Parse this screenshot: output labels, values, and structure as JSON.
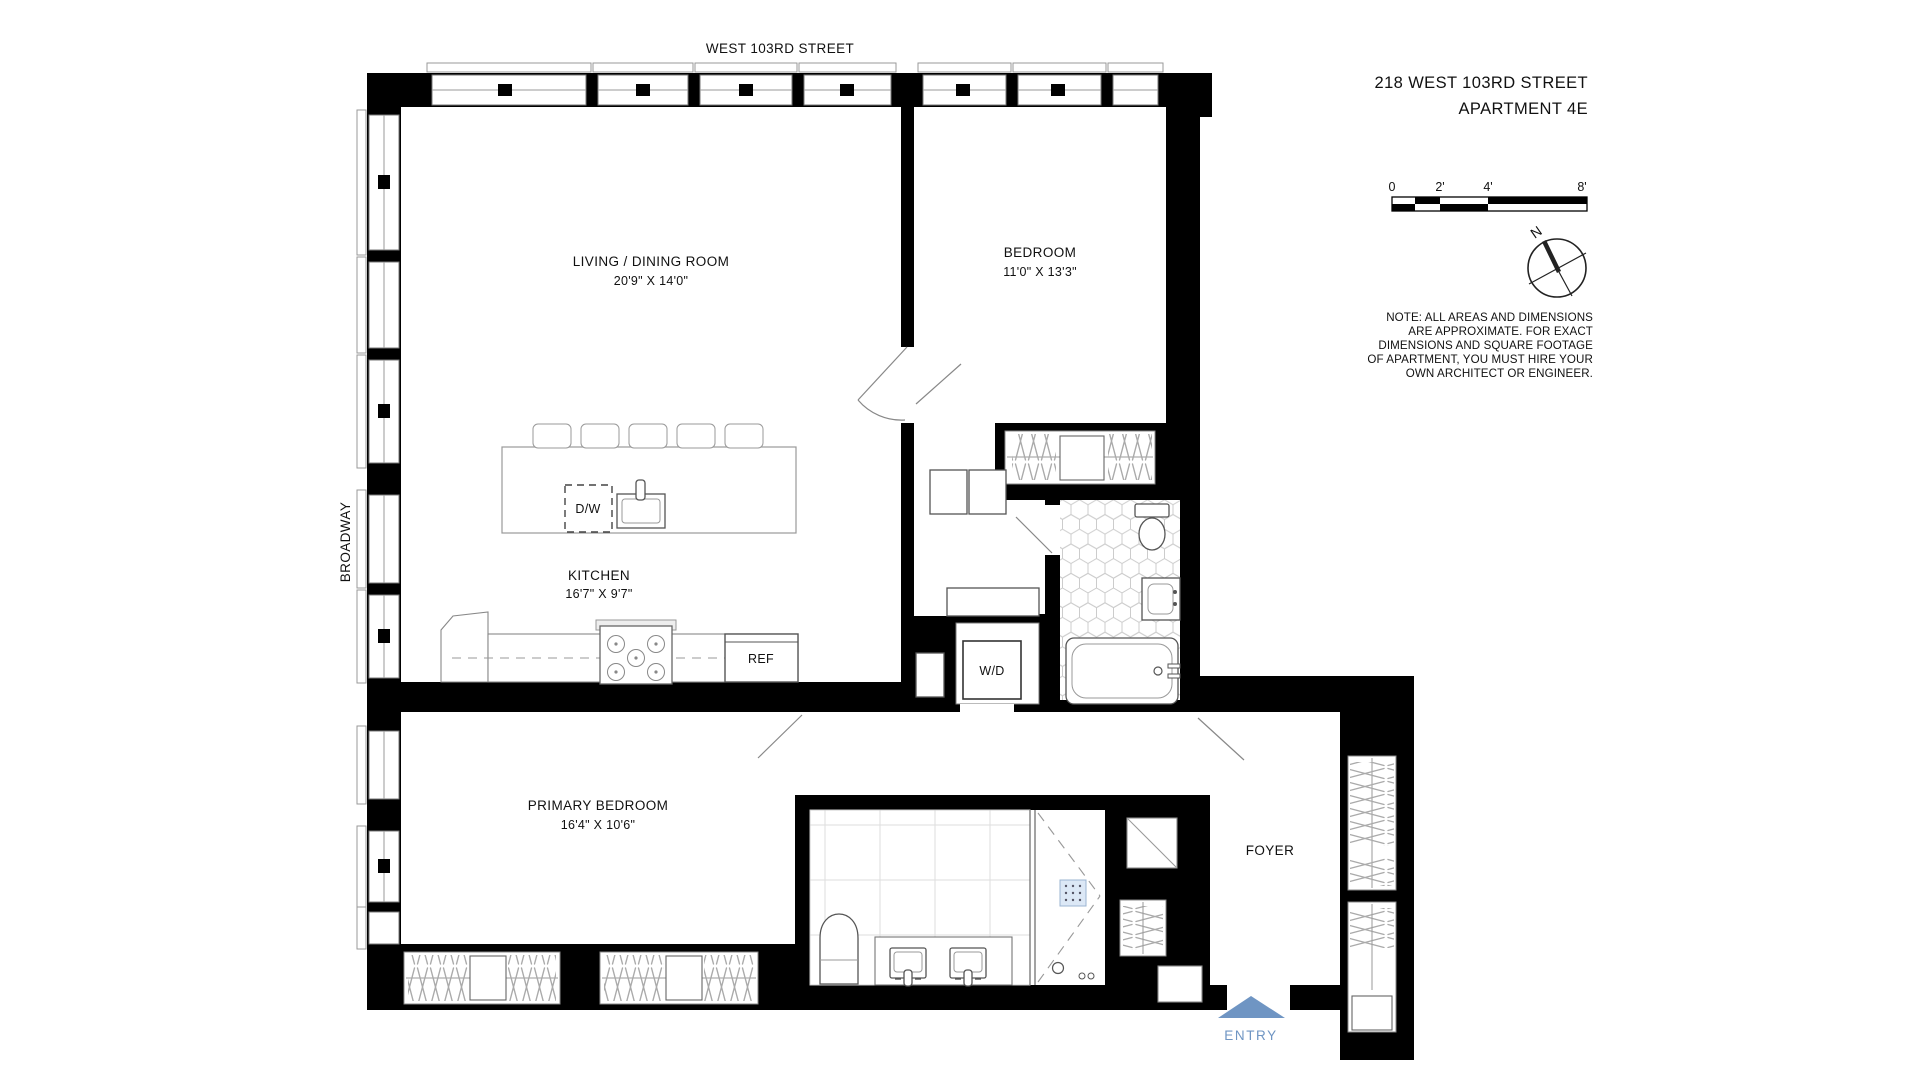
{
  "title": {
    "line1": "218 WEST 103RD STREET",
    "line2": "APARTMENT 4E"
  },
  "streets": {
    "top": "WEST 103RD STREET",
    "left": "BROADWAY"
  },
  "rooms": {
    "living": {
      "name": "LIVING / DINING ROOM",
      "dims": "20'9\" X 14'0\""
    },
    "bedroom": {
      "name": "BEDROOM",
      "dims": "11'0\" X 13'3\""
    },
    "kitchen": {
      "name": "KITCHEN",
      "dims": "16'7\" X 9'7\""
    },
    "primary": {
      "name": "PRIMARY BEDROOM",
      "dims": "16'4\" X 10'6\""
    },
    "foyer": {
      "name": "FOYER"
    }
  },
  "labels": {
    "dishwasher": "D/W",
    "refrigerator": "REF",
    "washer_dryer": "W/D",
    "entry": "ENTRY"
  },
  "scale_bar": {
    "ticks": [
      "0",
      "2'",
      "4'",
      "8'"
    ]
  },
  "compass": {
    "north": "N"
  },
  "note": {
    "lines": [
      "NOTE: ALL AREAS AND DIMENSIONS",
      "ARE APPROXIMATE. FOR EXACT",
      "DIMENSIONS AND SQUARE FOOTAGE",
      "OF APARTMENT, YOU MUST HIRE YOUR",
      "OWN ARCHITECT OR ENGINEER."
    ]
  },
  "colors": {
    "entry_accent": "#6f95c3",
    "wall": "#000000"
  }
}
